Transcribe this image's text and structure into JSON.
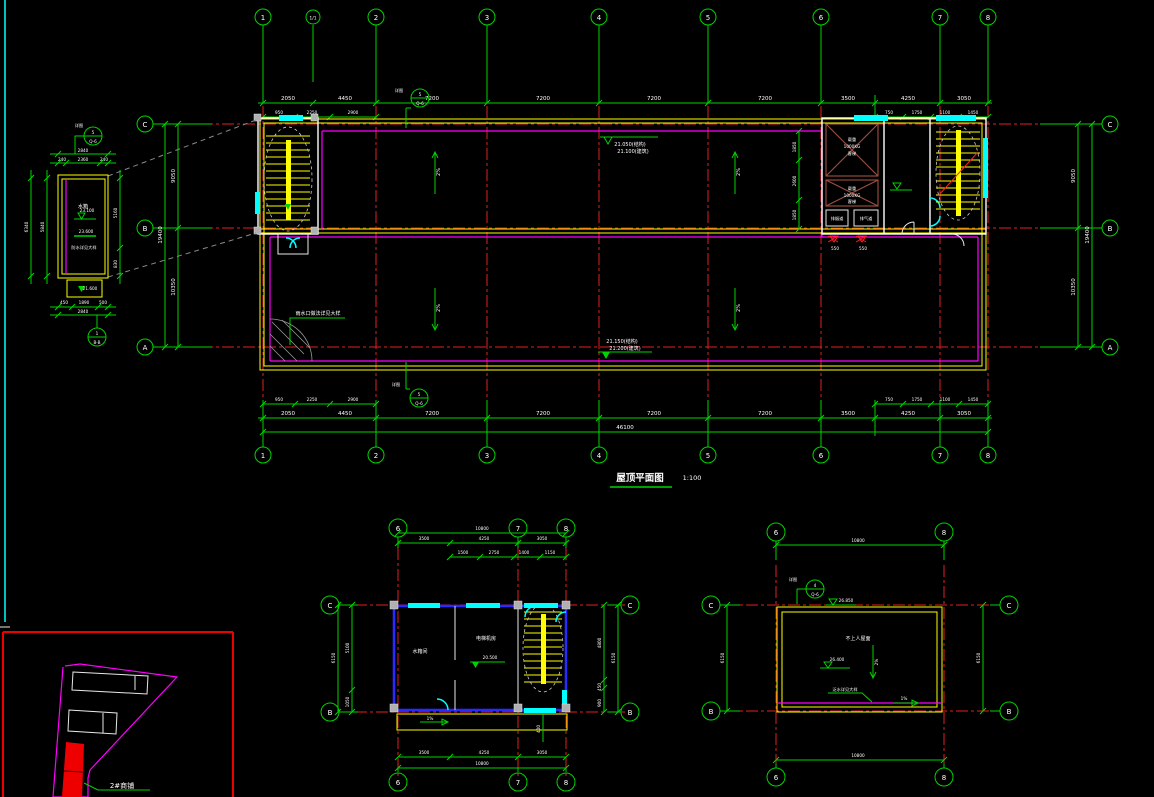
{
  "window": {
    "background": "#000000"
  },
  "colors": {
    "grid": "#00d400",
    "axis_red": "#e02020",
    "parapet": "#ffff00",
    "roof_line": "#ff00ff",
    "window_cyan": "#00ffff",
    "wall_white": "#ffffff",
    "wall_blue": "#2a2aff",
    "elevator_brown": "#a05040",
    "highlight_red": "#ee0000"
  },
  "main_plan": {
    "title": "屋顶平面图",
    "scale": "1:100",
    "grid_cols": [
      "1",
      "1/1",
      "2",
      "3",
      "4",
      "5",
      "6",
      "7",
      "8"
    ],
    "grid_rows": [
      "C",
      "B",
      "A"
    ],
    "dims_top": [
      "2050",
      "4450",
      "7200",
      "7200",
      "7200",
      "7200",
      "3500",
      "4250",
      "3050"
    ],
    "dims_top_sub": [
      "950",
      "2250",
      "2900",
      "750",
      "1750",
      "1100",
      "1450"
    ],
    "dims_bottom": [
      "2050",
      "4450",
      "7200",
      "7200",
      "7200",
      "7200",
      "3500",
      "4250",
      "3050"
    ],
    "dims_bottom_sub": [
      "950",
      "2250",
      "2900",
      "750",
      "1750",
      "1100",
      "1450"
    ],
    "total": "46100",
    "dims_left": [
      "9050",
      "10350"
    ],
    "left_total": "19400",
    "dims_right": [
      "9050",
      "10350"
    ],
    "right_total": "19400",
    "roof_inner_dims": [
      "1850",
      "2600",
      "1850"
    ],
    "elev_top_line1": "21.050(结构)",
    "elev_top_line2": "21.100(建筑)",
    "elev_bottom_line1": "21.150(结构)",
    "elev_bottom_line2": "21.200(建筑)",
    "slope": "2%",
    "drain_note": "雨水口做法详见大样",
    "callout_top": {
      "num": "5",
      "sheet": "Q-6",
      "label": "详图"
    },
    "callout_bottom": {
      "num": "5",
      "sheet": "Q-6",
      "label": "详图"
    },
    "elevator1": [
      "载重",
      "1000KG",
      "客梯"
    ],
    "elevator2": [
      "载重",
      "1000KG",
      "客梯"
    ],
    "flue1": "排烟道",
    "flue2": "排气道",
    "drain_dim1": "550",
    "drain_dim2": "550"
  },
  "tank_detail": {
    "room": "水箱",
    "elev_inner": "23.100",
    "elev_wall": "23.600",
    "elev_base": "21.600",
    "note": "防水详见大样",
    "top_total": "2840",
    "dims_top": [
      "240",
      "2360",
      "240"
    ],
    "dims_bottom": [
      "450",
      "1890",
      "500"
    ],
    "bottom_total": "2840",
    "left_inner": "5840",
    "left_total": "6340",
    "right_dims": [
      "5160",
      "830"
    ],
    "callout_top": {
      "num": "5",
      "sheet": "Q-6",
      "label": "详图"
    },
    "callout_bottom": {
      "num": "1",
      "sheet": "B-B"
    }
  },
  "machine_room_plan": {
    "grid_cols": [
      "6",
      "7",
      "8"
    ],
    "grid_rows": [
      "C",
      "B"
    ],
    "room1": "水箱间",
    "room2": "电梯机房",
    "elev": "20.500",
    "awning_slope": "1%",
    "top_total": "10800",
    "dims_top": [
      "3500",
      "4250",
      "3050"
    ],
    "dims_top_sub": [
      "1500",
      "2750",
      "1400",
      "1150"
    ],
    "dims_bottom": [
      "3500",
      "4250",
      "3050"
    ],
    "bottom_total": "10800",
    "dims_left": [
      "5100",
      "1050"
    ],
    "left_total": "6150",
    "dims_right": [
      "4800",
      "450",
      "900"
    ],
    "right_total": "6150",
    "stair_dim": "400"
  },
  "roof_detail_plan": {
    "grid_cols": [
      "6",
      "8"
    ],
    "grid_rows": [
      "C",
      "B"
    ],
    "label": "不上人屋面",
    "elev_top": "26.850",
    "elev_mid": "26.400",
    "slope": "2%",
    "slope2": "1%",
    "note": "泛水详见大样",
    "callout": {
      "num": "4",
      "sheet": "Q-6",
      "label": "详图"
    },
    "top_total": "10800",
    "bottom_total": "10800",
    "left_total": "6150",
    "right_total": "6150"
  },
  "key_plan": {
    "label": "2#商铺"
  }
}
